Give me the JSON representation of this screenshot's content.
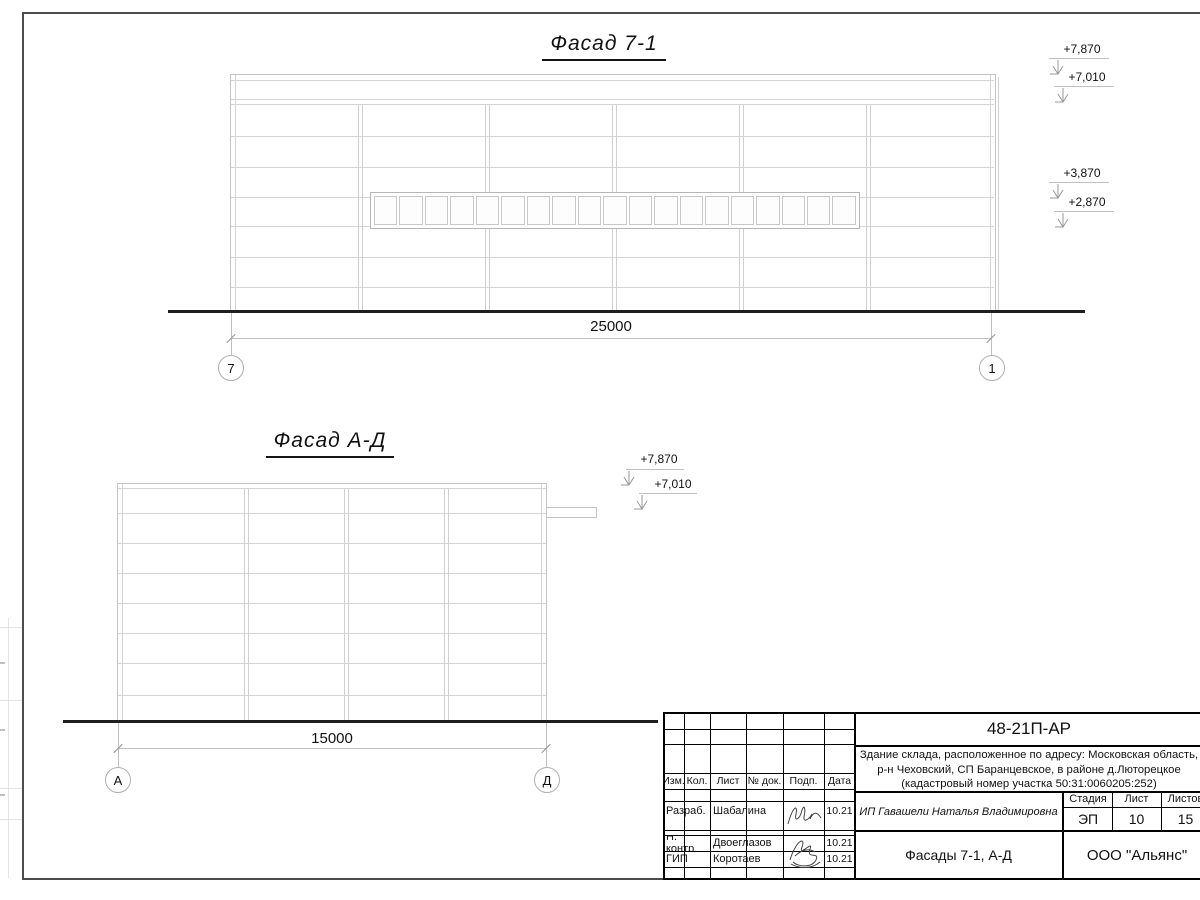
{
  "colors": {
    "line_light": "#d4d4d4",
    "line_dark": "#1f1f1f",
    "frame": "#4d4d4d",
    "text": "#111111"
  },
  "facade1": {
    "title": "Фасад 7-1",
    "dimension": "25000",
    "axis_left": "7",
    "axis_right": "1",
    "window_count": 19,
    "elevations": [
      {
        "label": "+7,870"
      },
      {
        "label": "+7,010"
      },
      {
        "label": "+3,870"
      },
      {
        "label": "+2,870"
      }
    ]
  },
  "facade2": {
    "title": "Фасад А-Д",
    "dimension": "15000",
    "axis_left": "А",
    "axis_right": "Д",
    "elevations": [
      {
        "label": "+7,870"
      },
      {
        "label": "+7,010"
      }
    ]
  },
  "titleblock": {
    "doc_number": "48-21П-АР",
    "address_line1": "Здание склада, расположенное по адресу: Московская область,",
    "address_line2": "р-н Чеховский, СП Баранцевское, в районе д.Люторецкое",
    "address_line3": "(кадастровый номер участка 50:31:0060205:252)",
    "header_cols": [
      "Изм.",
      "Кол.",
      "Лист",
      "№ док.",
      "Подп.",
      "Дата"
    ],
    "rows": [
      {
        "role": "Разраб.",
        "name": "Шабалина",
        "date": "10.21"
      },
      {
        "role": "Н. контр.",
        "name": "Двоеглазов",
        "date": "10.21"
      },
      {
        "role": "ГИП",
        "name": "Коротаев",
        "date": "10.21"
      }
    ],
    "client": "ИП Гавашели Наталья Владимировна",
    "stage_label": "Стадия",
    "sheet_label": "Лист",
    "sheets_label": "Листов",
    "stage": "ЭП",
    "sheet": "10",
    "sheets": "15",
    "sheet_title": "Фасады 7-1, А-Д",
    "company": "ООО \"Альянс\""
  }
}
